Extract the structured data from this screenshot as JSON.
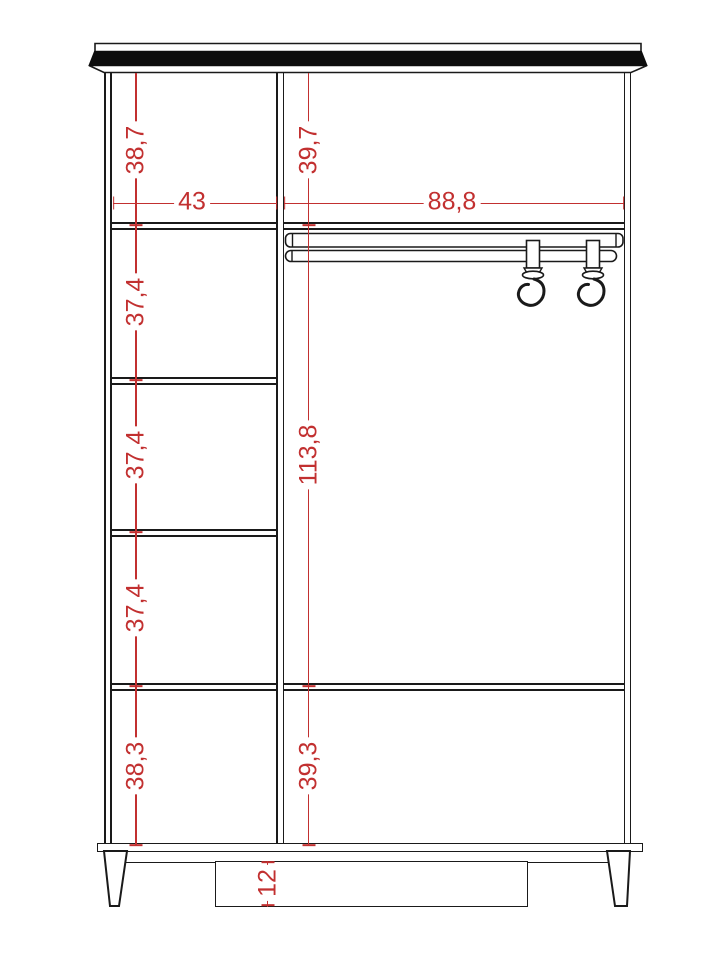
{
  "drawing": {
    "kind": "wardrobe-front-elevation",
    "colors": {
      "dimension_red": "#c23030",
      "line_black": "#1a1a1a",
      "cornice_fill": "#0d0d0d",
      "background": "#ffffff"
    }
  },
  "dimensions": {
    "left_sections": [
      "38,7",
      "37,4",
      "37,4",
      "37,4",
      "38,3"
    ],
    "right_sections": [
      "39,7",
      "113,8",
      "39,3"
    ],
    "widths": [
      "43",
      "88,8"
    ],
    "leg_height": "12"
  }
}
